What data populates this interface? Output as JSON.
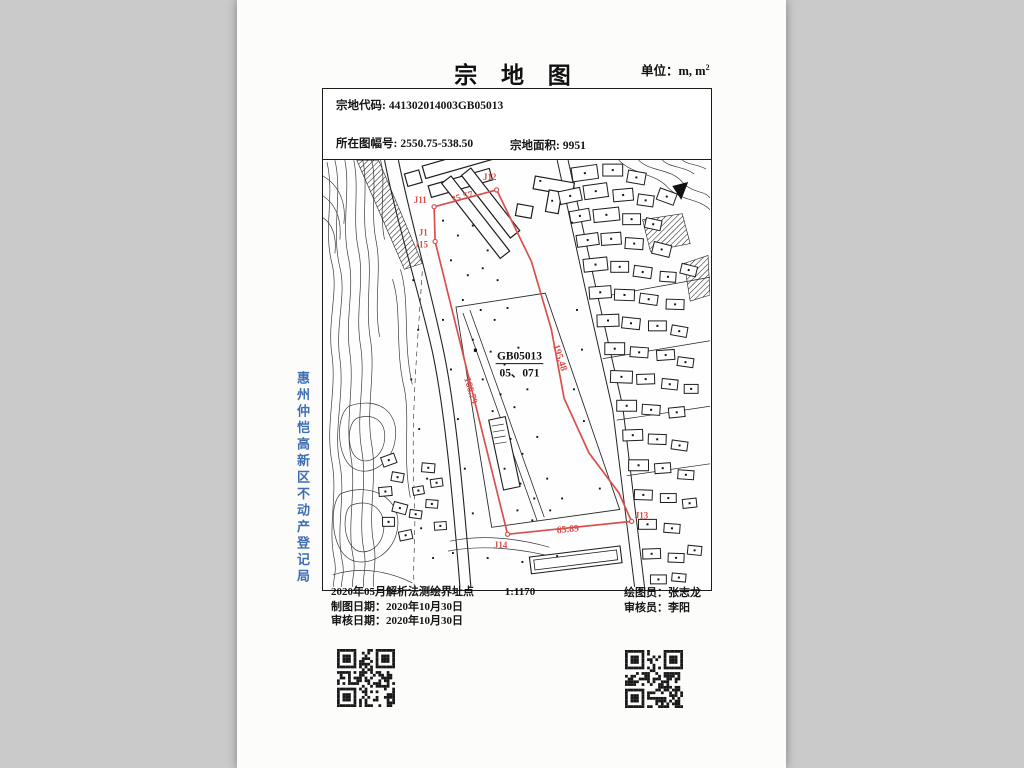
{
  "page": {
    "title": "宗 地 图",
    "unit_prefix": "单位：m, m",
    "unit_sup": "2"
  },
  "header": {
    "parcel_code_label": "宗地代码:",
    "parcel_code_value": "441302014003GB05013",
    "sheet_label": "所在图幅号:",
    "sheet_value": "2550.75-538.50",
    "area_label": "宗地面积:",
    "area_value": "9951"
  },
  "side_text": "惠州仲恺高新区不动产登记局",
  "map": {
    "parcel_code_short": "GB05013",
    "parcel_subcode": "05、071",
    "points": {
      "j11": "J11",
      "j12": "J12",
      "j13": "J13",
      "j14": "J14",
      "j15": "J15",
      "j1": "J1"
    },
    "edges": {
      "top": "35.57",
      "right": "195.48",
      "bottom": "65.89",
      "left": "166.79"
    }
  },
  "footer": {
    "survey_note": "2020年05月解析法测绘界址点",
    "draw_date_label": "制图日期：",
    "draw_date": "2020年10月30日",
    "review_date_label": "审核日期：",
    "review_date": "2020年10月30日",
    "scale": "1:1170",
    "drafter_label": "绘图员：",
    "drafter": "张志龙",
    "reviewer_label": "审核员：",
    "reviewer": "李阳"
  }
}
